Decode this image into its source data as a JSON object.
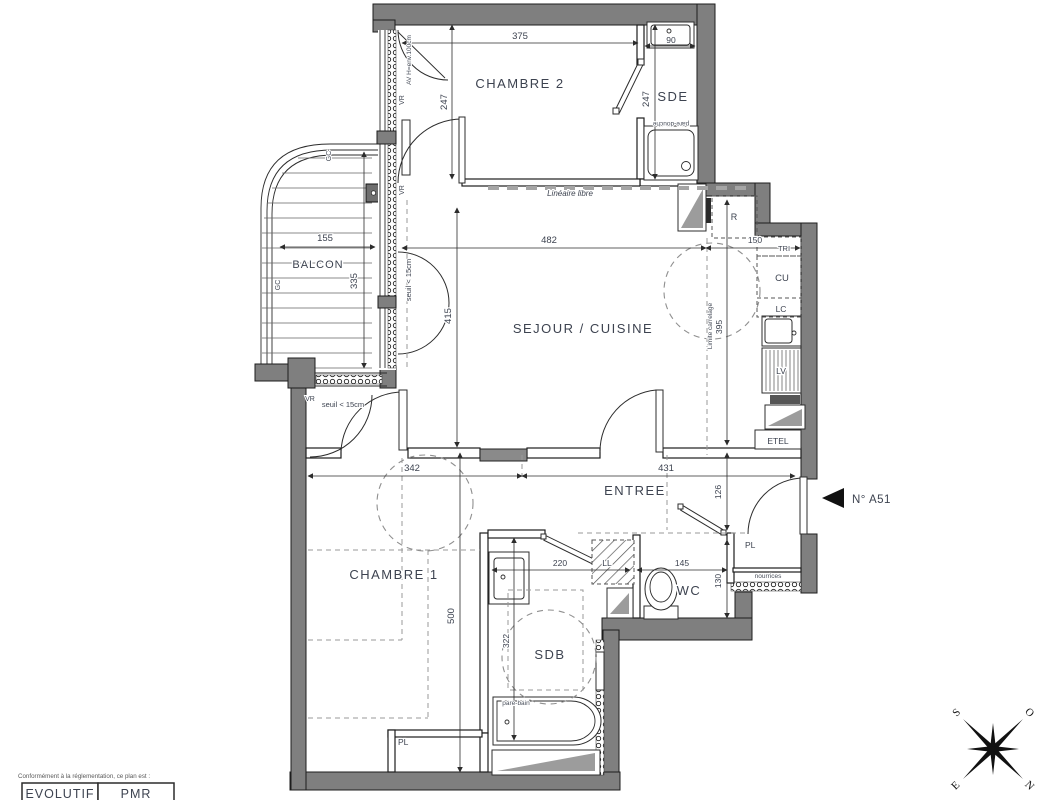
{
  "unit": {
    "number": "N° A51"
  },
  "rooms": {
    "chambre2": "CHAMBRE 2",
    "sde": "SDE",
    "balcon": "BALCON",
    "sejour": "SEJOUR / CUISINE",
    "entree": "ENTREE",
    "chambre1": "CHAMBRE 1",
    "wc": "WC",
    "sdb": "SDB"
  },
  "dims": {
    "chambre2_width": "375",
    "sde_basin_width": "90",
    "chambre2_depth": "247",
    "sde_depth": "247",
    "balcon_width": "155",
    "balcon_depth": "335",
    "sejour_width": "482",
    "cuisine_width": "150",
    "sejour_depth": "415",
    "carrelage_depth": "395",
    "chambre1_width": "342",
    "entree_width": "431",
    "entree_depth": "126",
    "sdb_width": "220",
    "wc_width": "145",
    "wc_depth": "130",
    "chambre1_depth": "500",
    "sdb_depth": "322"
  },
  "annotations": {
    "lineaire_libre": "Linéaire libre",
    "limite_carrelage": "Limite carrelage",
    "seuil": "seuil < 15cm",
    "vr": "VR",
    "gc": "GC",
    "av_height": "AV H=env.100cm",
    "pare_douche": "pare-douche",
    "pare_bain": "pare-bain",
    "nourrices": "nourrices",
    "pl": "PL",
    "ll": "LL"
  },
  "kitchen": {
    "r": "R",
    "tri": "TRI",
    "cu": "CU",
    "lc": "LC",
    "lv": "LV",
    "etel": "ETEL"
  },
  "footer": {
    "note": "Conformément à la réglementation, ce plan est :",
    "evolutif": "EVOLUTIF",
    "pmr": "PMR"
  },
  "compass": {
    "n": "N",
    "s": "S",
    "e": "E",
    "o": "O"
  },
  "colors": {
    "wall": "#7f7f7f",
    "line": "#2c2c2c",
    "text": "#3d4350",
    "dash": "#999999"
  }
}
